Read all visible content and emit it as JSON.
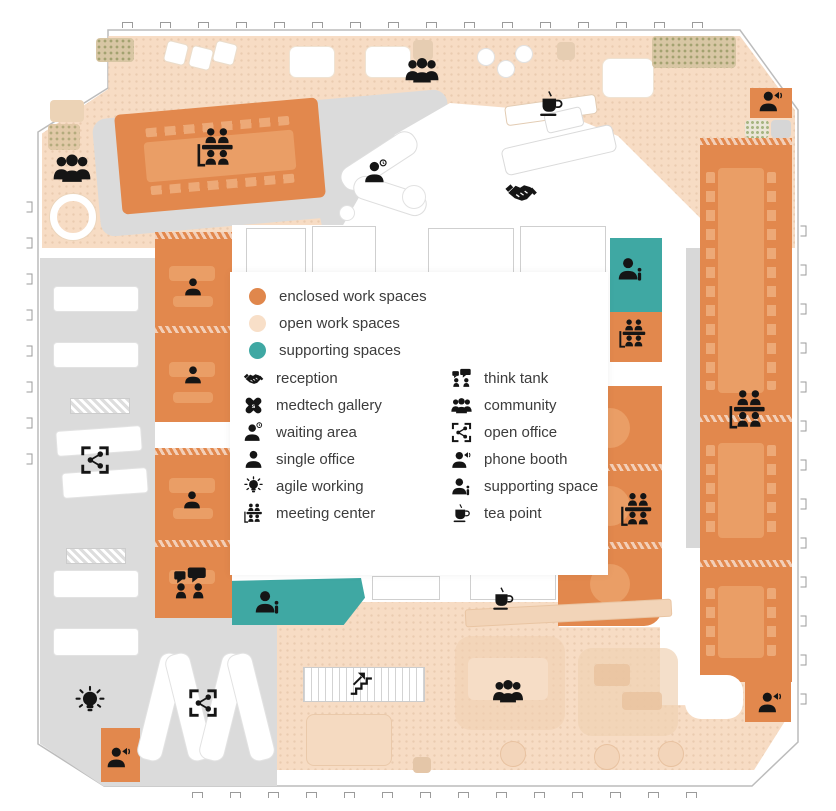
{
  "legend": {
    "categories": [
      {
        "name": "enclosed",
        "label": "enclosed work spaces",
        "color": "#E0874C"
      },
      {
        "name": "open",
        "label": "open work spaces",
        "color": "#F8DFC8"
      },
      {
        "name": "supporting",
        "label": "supporting spaces",
        "color": "#3FA8A3"
      }
    ],
    "items_left": [
      {
        "icon": "reception",
        "label": "reception"
      },
      {
        "icon": "medtech-gallery",
        "label": "medtech gallery"
      },
      {
        "icon": "waiting-area",
        "label": "waiting area"
      },
      {
        "icon": "single-office",
        "label": "single office"
      },
      {
        "icon": "agile-working",
        "label": "agile working"
      },
      {
        "icon": "meeting-center",
        "label": "meeting center"
      }
    ],
    "items_right": [
      {
        "icon": "think-tank",
        "label": "think tank"
      },
      {
        "icon": "community",
        "label": "community"
      },
      {
        "icon": "open-office",
        "label": "open office"
      },
      {
        "icon": "phone-booth",
        "label": "phone booth"
      },
      {
        "icon": "supporting-space",
        "label": "supporting space"
      },
      {
        "icon": "tea-point",
        "label": "tea point"
      }
    ]
  },
  "colors": {
    "enclosed": "#E2884D",
    "enclosed_furniture": "#EA9E66",
    "open": "#F7DCC4",
    "open_furniture": "#F1CFAF",
    "supporting": "#3FA8A3",
    "circulation": "#DBDBDB",
    "outline": "#C9C9C9",
    "icon": "#151515",
    "text": "#3C3C3C"
  },
  "plan": {
    "markers": [
      {
        "icon": "community",
        "x": 72,
        "y": 168,
        "s": 38
      },
      {
        "icon": "meeting-center",
        "x": 216,
        "y": 148,
        "s": 42
      },
      {
        "icon": "waiting-area",
        "x": 376,
        "y": 172,
        "s": 26
      },
      {
        "icon": "community",
        "x": 422,
        "y": 70,
        "s": 34
      },
      {
        "icon": "tea-point",
        "x": 551,
        "y": 104,
        "s": 29
      },
      {
        "icon": "reception",
        "x": 521,
        "y": 192,
        "s": 34
      },
      {
        "icon": "phone-booth",
        "x": 771,
        "y": 101,
        "s": 26
      },
      {
        "icon": "supporting-space",
        "x": 631,
        "y": 269,
        "s": 28
      },
      {
        "icon": "meeting-center",
        "x": 633,
        "y": 334,
        "s": 31
      },
      {
        "icon": "single-office",
        "x": 193,
        "y": 287,
        "s": 21
      },
      {
        "icon": "single-office",
        "x": 193,
        "y": 375,
        "s": 21
      },
      {
        "icon": "open-office",
        "x": 95,
        "y": 460,
        "s": 30
      },
      {
        "icon": "single-office",
        "x": 192,
        "y": 500,
        "s": 21
      },
      {
        "icon": "meeting-center",
        "x": 748,
        "y": 410,
        "s": 42
      },
      {
        "icon": "meeting-center",
        "x": 637,
        "y": 510,
        "s": 36
      },
      {
        "icon": "think-tank",
        "x": 190,
        "y": 584,
        "s": 36
      },
      {
        "icon": "supporting-space",
        "x": 268,
        "y": 602,
        "s": 28
      },
      {
        "icon": "tea-point",
        "x": 503,
        "y": 599,
        "s": 26
      },
      {
        "icon": "agile-working",
        "x": 90,
        "y": 702,
        "s": 33
      },
      {
        "icon": "open-office",
        "x": 203,
        "y": 703,
        "s": 30
      },
      {
        "icon": "stairs",
        "x": 362,
        "y": 683,
        "s": 27
      },
      {
        "icon": "community",
        "x": 508,
        "y": 691,
        "s": 31
      },
      {
        "icon": "phone-booth",
        "x": 119,
        "y": 757,
        "s": 26
      },
      {
        "icon": "phone-booth",
        "x": 770,
        "y": 702,
        "s": 26
      }
    ]
  }
}
